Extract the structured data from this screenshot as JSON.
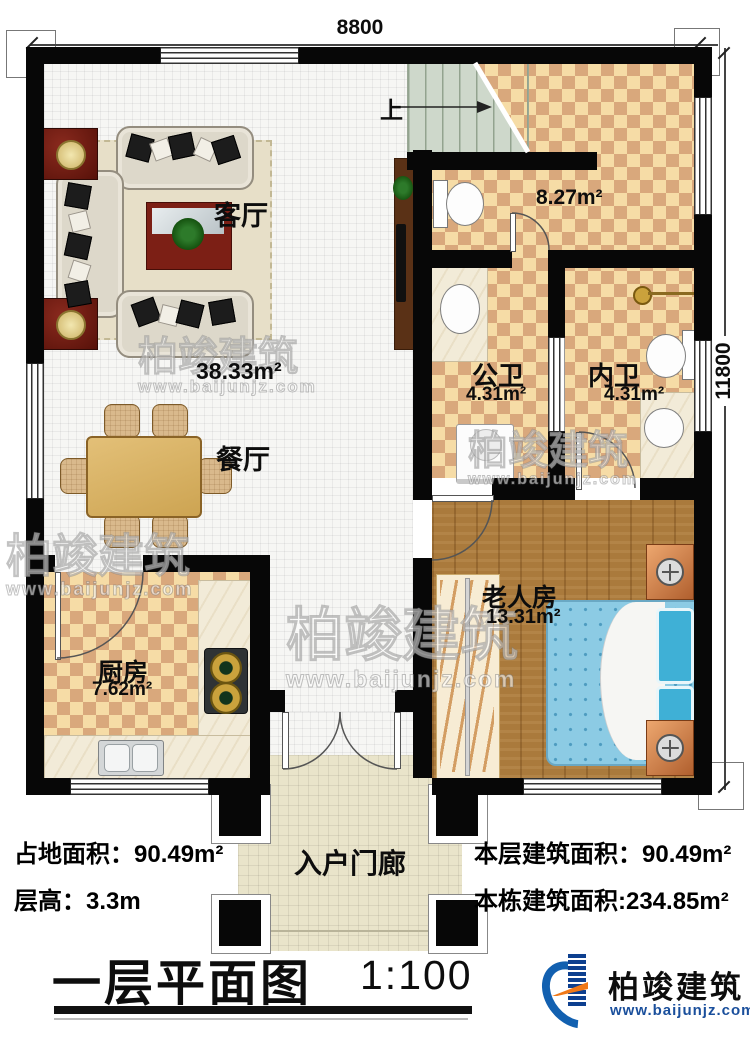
{
  "plan": {
    "dimensions": {
      "top_width": "8800",
      "right_height": "11800"
    },
    "stairs_up_label": "上",
    "rooms": {
      "living": {
        "name": "客厅",
        "area": "38.33m²"
      },
      "dining": {
        "name": "餐厅"
      },
      "kitchen": {
        "name": "厨房",
        "area": "7.62m²"
      },
      "stair_hall": {
        "area": "8.27m²"
      },
      "public_bath": {
        "name": "公卫",
        "area": "4.31m²"
      },
      "inner_bath": {
        "name": "内卫",
        "area": "4.31m²"
      },
      "elder_bedroom": {
        "name": "老人房",
        "area": "13.31m²"
      },
      "entry_porch": {
        "name": "入户门廊"
      }
    }
  },
  "footer": {
    "site_area": "占地面积：90.49m²",
    "floor_height": "层高：3.3m",
    "floor_built_area": "本层建筑面积：90.49m²",
    "total_built_area": "本栋建筑面积:234.85m²"
  },
  "title": {
    "text": "一层平面图",
    "scale": "1:100"
  },
  "brand": {
    "company": "柏竣建筑",
    "website": "www.baijunjz.com"
  },
  "watermark": {
    "text": "柏竣建筑",
    "website": "www.baijunjz.com"
  },
  "colors": {
    "wall": "#070707",
    "tile_light": "#f6dca6",
    "tile_dark": "#d9a87c",
    "wood_floor": "#aa7a3c",
    "porch_tile": "#e9e4ca",
    "bed_blue": "#8ccbe4",
    "logo_blue": "#1260b0",
    "logo_orange": "#f07818"
  }
}
